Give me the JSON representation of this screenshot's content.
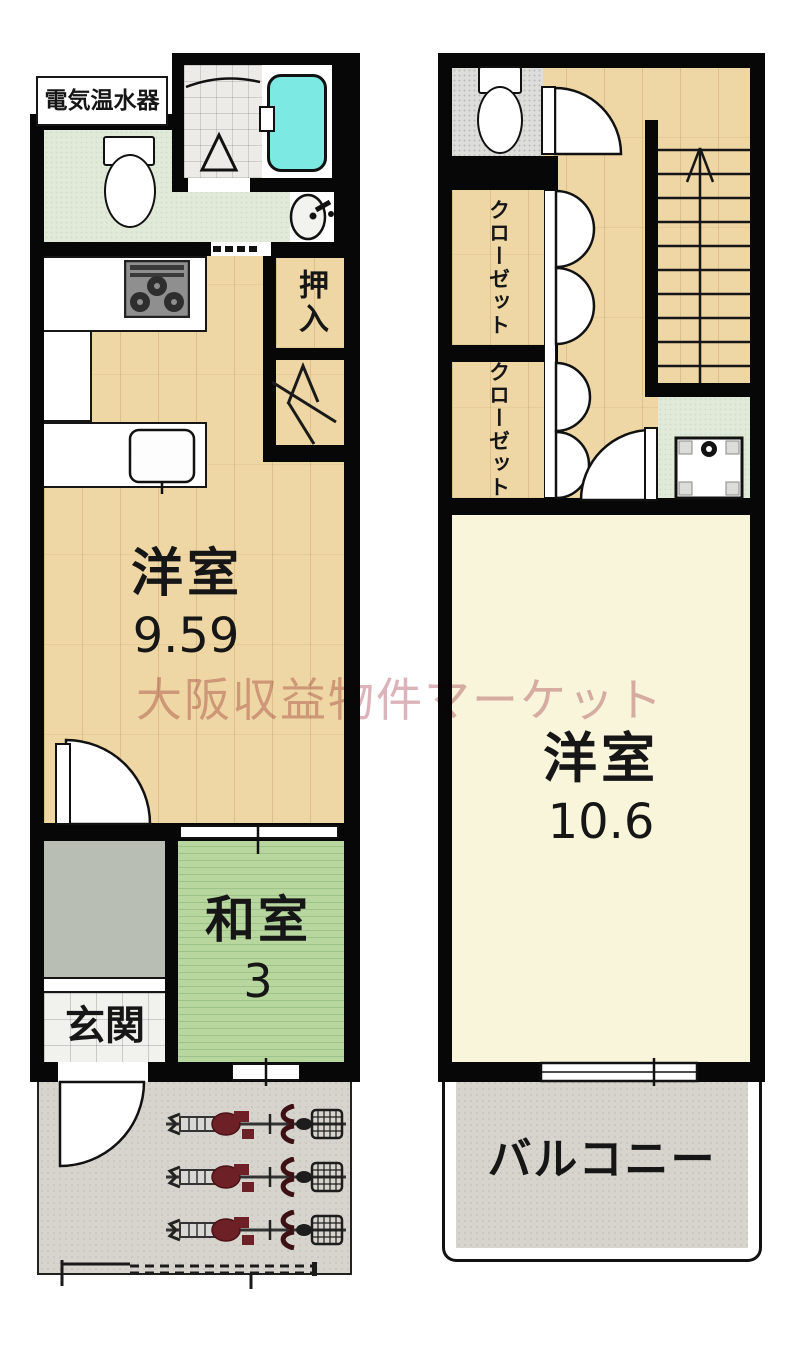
{
  "watermark": "大阪収益物件マーケット",
  "floor1": {
    "water_heater_label": "電気温水器",
    "oshiire_label": "押入",
    "living_room": {
      "name": "洋室",
      "size": "9.59"
    },
    "tatami_room": {
      "name": "和室",
      "size": "3"
    },
    "entrance_label": "玄関"
  },
  "floor2": {
    "closet_upper_label": "クローゼット",
    "closet_lower_label": "クローゼット",
    "bedroom": {
      "name": "洋室",
      "size": "10.6"
    },
    "balcony_label": "バルコニー"
  },
  "colors": {
    "wall": "#070707",
    "wood_floor": "#eed7a4",
    "tatami_green": "#b7d79f",
    "bathtub_cyan": "#7de9e3",
    "hall_mint": "#e1ead9",
    "bedroom_cream": "#f8f5da",
    "outdoor_gray": "#d6d4cd",
    "bicycle_red": "#6d2127",
    "watermark_pink": "#dcb3bb"
  }
}
